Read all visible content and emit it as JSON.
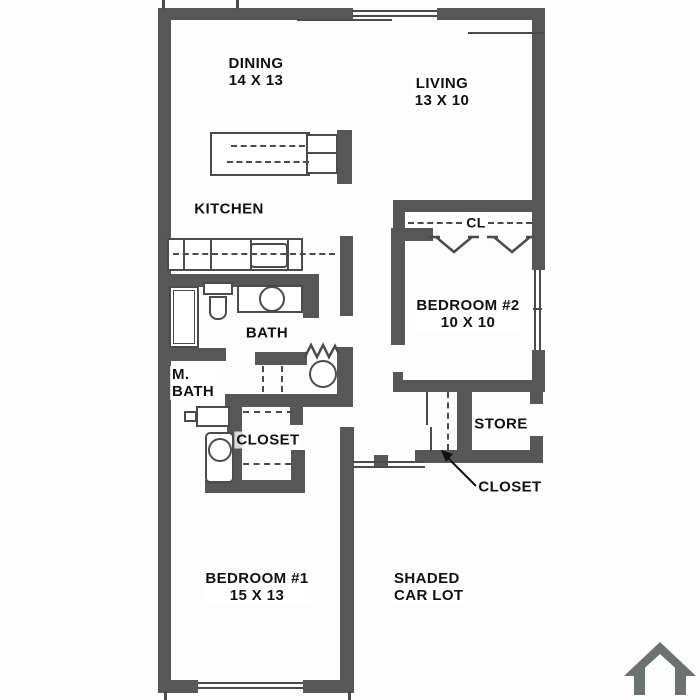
{
  "colors": {
    "wall": "#575757",
    "line": "#4b4b4b",
    "text": "#111111",
    "background": "#fdfdfd",
    "house_icon": "#6b7270"
  },
  "rooms": {
    "dining": {
      "name": "DINING",
      "dims": "14 X 13"
    },
    "living": {
      "name": "LIVING",
      "dims": "13 X 10"
    },
    "kitchen": {
      "name": "KITCHEN"
    },
    "cl": {
      "name": "CL"
    },
    "bedroom2": {
      "name": "BEDROOM #2",
      "dims": "10 X 10"
    },
    "bath": {
      "name": "BATH"
    },
    "master_bath": {
      "line1": "M.",
      "line2": "BATH"
    },
    "master_closet": {
      "name": "CLOSET"
    },
    "store": {
      "name": "STORE"
    },
    "closet_callout": {
      "name": "CLOSET"
    },
    "bedroom1": {
      "name": "BEDROOM #1",
      "dims": "15 X 13"
    },
    "car_lot": {
      "line1": "SHADED",
      "line2": "CAR LOT"
    }
  },
  "icons": {
    "house": "house-icon"
  }
}
